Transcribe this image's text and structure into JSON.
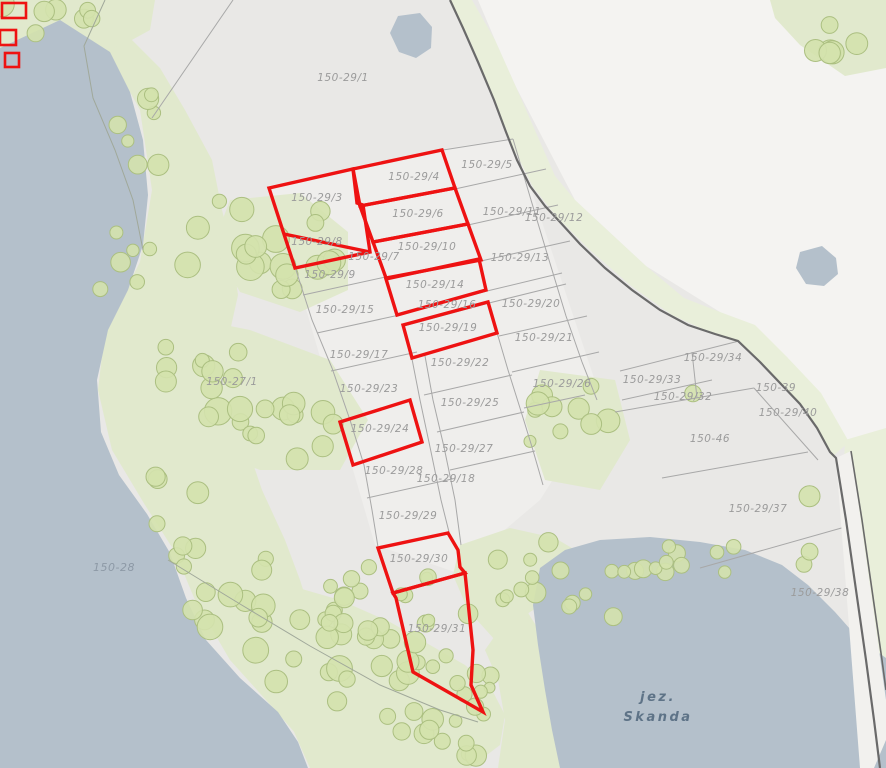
{
  "map": {
    "title": "cadastral-parcel-map",
    "colors": {
      "base": "#e9e8e6",
      "white_region": "#f4f3f1",
      "parcel_fill": "#efeeec",
      "water": "#b4c0cb",
      "green": "#e1e9cd",
      "green_strip": "#e9efda",
      "tree_fill": "#d4e2ad",
      "tree_stroke": "#abbf80",
      "gray_line": "#a8a8a8",
      "dark_line": "#6a6a6a",
      "road_fill": "#f2f1ee",
      "red": "#ee1212",
      "label": "#9b9b9b",
      "water_label": "#8d99a6",
      "lake_label": "#5e7387"
    },
    "labels": [
      {
        "text": "150-29/1",
        "x": 343,
        "y": 81,
        "kind": "parcel"
      },
      {
        "text": "150-29/4",
        "x": 414,
        "y": 180,
        "kind": "parcel"
      },
      {
        "text": "150-29/5",
        "x": 487,
        "y": 168,
        "kind": "parcel"
      },
      {
        "text": "150-29/3",
        "x": 317,
        "y": 201,
        "kind": "parcel"
      },
      {
        "text": "150-29/6",
        "x": 418,
        "y": 217,
        "kind": "parcel"
      },
      {
        "text": "150-29/11",
        "x": 512,
        "y": 215,
        "kind": "parcel"
      },
      {
        "text": "150-29/12",
        "x": 554,
        "y": 221,
        "kind": "parcel"
      },
      {
        "text": "150-29/8",
        "x": 317,
        "y": 245,
        "kind": "parcel"
      },
      {
        "text": "150-29/10",
        "x": 427,
        "y": 250,
        "kind": "parcel"
      },
      {
        "text": "150-29/7",
        "x": 374,
        "y": 260,
        "kind": "parcel"
      },
      {
        "text": "150-29/13",
        "x": 520,
        "y": 261,
        "kind": "parcel"
      },
      {
        "text": "150-29/9",
        "x": 330,
        "y": 278,
        "kind": "parcel"
      },
      {
        "text": "150-29/14",
        "x": 435,
        "y": 288,
        "kind": "parcel"
      },
      {
        "text": "150-29/15",
        "x": 345,
        "y": 313,
        "kind": "parcel"
      },
      {
        "text": "150-29/16",
        "x": 447,
        "y": 308,
        "kind": "parcel"
      },
      {
        "text": "150-29/20",
        "x": 531,
        "y": 307,
        "kind": "parcel"
      },
      {
        "text": "150-29/19",
        "x": 448,
        "y": 331,
        "kind": "parcel"
      },
      {
        "text": "150-29/21",
        "x": 544,
        "y": 341,
        "kind": "parcel"
      },
      {
        "text": "150-29/17",
        "x": 359,
        "y": 358,
        "kind": "parcel"
      },
      {
        "text": "150-29/22",
        "x": 460,
        "y": 366,
        "kind": "parcel"
      },
      {
        "text": "150-29/34",
        "x": 713,
        "y": 361,
        "kind": "parcel"
      },
      {
        "text": "150-27/1",
        "x": 232,
        "y": 385,
        "kind": "parcel"
      },
      {
        "text": "150-29/26",
        "x": 562,
        "y": 387,
        "kind": "parcel"
      },
      {
        "text": "150-29/33",
        "x": 652,
        "y": 383,
        "kind": "parcel"
      },
      {
        "text": "150-29/23",
        "x": 369,
        "y": 392,
        "kind": "parcel"
      },
      {
        "text": "150-29/32",
        "x": 683,
        "y": 400,
        "kind": "parcel"
      },
      {
        "text": "150-39",
        "x": 776,
        "y": 391,
        "kind": "parcel"
      },
      {
        "text": "150-29/25",
        "x": 470,
        "y": 406,
        "kind": "parcel"
      },
      {
        "text": "150-29/40",
        "x": 788,
        "y": 416,
        "kind": "parcel"
      },
      {
        "text": "150-29/24",
        "x": 380,
        "y": 432,
        "kind": "parcel"
      },
      {
        "text": "150-46",
        "x": 710,
        "y": 442,
        "kind": "parcel"
      },
      {
        "text": "150-29/27",
        "x": 464,
        "y": 452,
        "kind": "parcel"
      },
      {
        "text": "150-29/28",
        "x": 394,
        "y": 474,
        "kind": "parcel"
      },
      {
        "text": "150-29/18",
        "x": 446,
        "y": 482,
        "kind": "parcel"
      },
      {
        "text": "150-29/29",
        "x": 408,
        "y": 519,
        "kind": "parcel"
      },
      {
        "text": "150-29/37",
        "x": 758,
        "y": 512,
        "kind": "parcel"
      },
      {
        "text": "150-28",
        "x": 114,
        "y": 571,
        "kind": "water"
      },
      {
        "text": "150-29/30",
        "x": 419,
        "y": 562,
        "kind": "parcel"
      },
      {
        "text": "150-29/38",
        "x": 820,
        "y": 596,
        "kind": "parcel"
      },
      {
        "text": "150-29/31",
        "x": 437,
        "y": 632,
        "kind": "parcel"
      },
      {
        "text": "jez.",
        "x": 658,
        "y": 701,
        "kind": "lake"
      },
      {
        "text": "Skanda",
        "x": 658,
        "y": 721,
        "kind": "lake"
      }
    ],
    "selected_parcels": [
      {
        "name": "150-29/3-8",
        "points": [
          [
            269,
            188
          ],
          [
            353,
            169
          ],
          [
            357,
            203
          ],
          [
            363,
            205
          ],
          [
            370,
            252
          ],
          [
            295,
            268
          ]
        ]
      },
      {
        "name": "150-29/4",
        "points": [
          [
            353,
            169
          ],
          [
            442,
            150
          ],
          [
            455,
            188
          ],
          [
            360,
            206
          ]
        ]
      },
      {
        "name": "150-29/6",
        "points": [
          [
            360,
            206
          ],
          [
            455,
            188
          ],
          [
            468,
            224
          ],
          [
            373,
            242
          ]
        ]
      },
      {
        "name": "150-29/10",
        "points": [
          [
            373,
            242
          ],
          [
            468,
            224
          ],
          [
            481,
            260
          ],
          [
            386,
            278
          ]
        ]
      },
      {
        "name": "150-29/14",
        "points": [
          [
            386,
            279
          ],
          [
            479,
            259
          ],
          [
            486,
            290
          ],
          [
            397,
            315
          ]
        ]
      },
      {
        "name": "150-29/19",
        "points": [
          [
            403,
            325
          ],
          [
            488,
            302
          ],
          [
            497,
            333
          ],
          [
            412,
            358
          ]
        ]
      },
      {
        "name": "150-29/24",
        "points": [
          [
            340,
            422
          ],
          [
            410,
            400
          ],
          [
            422,
            442
          ],
          [
            353,
            465
          ]
        ]
      },
      {
        "name": "150-29/30",
        "points": [
          [
            378,
            548
          ],
          [
            448,
            533
          ],
          [
            458,
            550
          ],
          [
            460,
            567
          ],
          [
            465,
            573
          ],
          [
            393,
            593
          ]
        ]
      },
      {
        "name": "150-29/31",
        "points": [
          [
            393,
            593
          ],
          [
            465,
            573
          ],
          [
            473,
            650
          ],
          [
            471,
            685
          ],
          [
            483,
            712
          ],
          [
            413,
            672
          ],
          [
            396,
            598
          ]
        ]
      }
    ],
    "selected_divider": [
      [
        284,
        234
      ],
      [
        370,
        252
      ]
    ],
    "corner_markers": [
      [
        2,
        3,
        24,
        15
      ],
      [
        0,
        30,
        16,
        15
      ],
      [
        5,
        53,
        14,
        14
      ]
    ]
  }
}
